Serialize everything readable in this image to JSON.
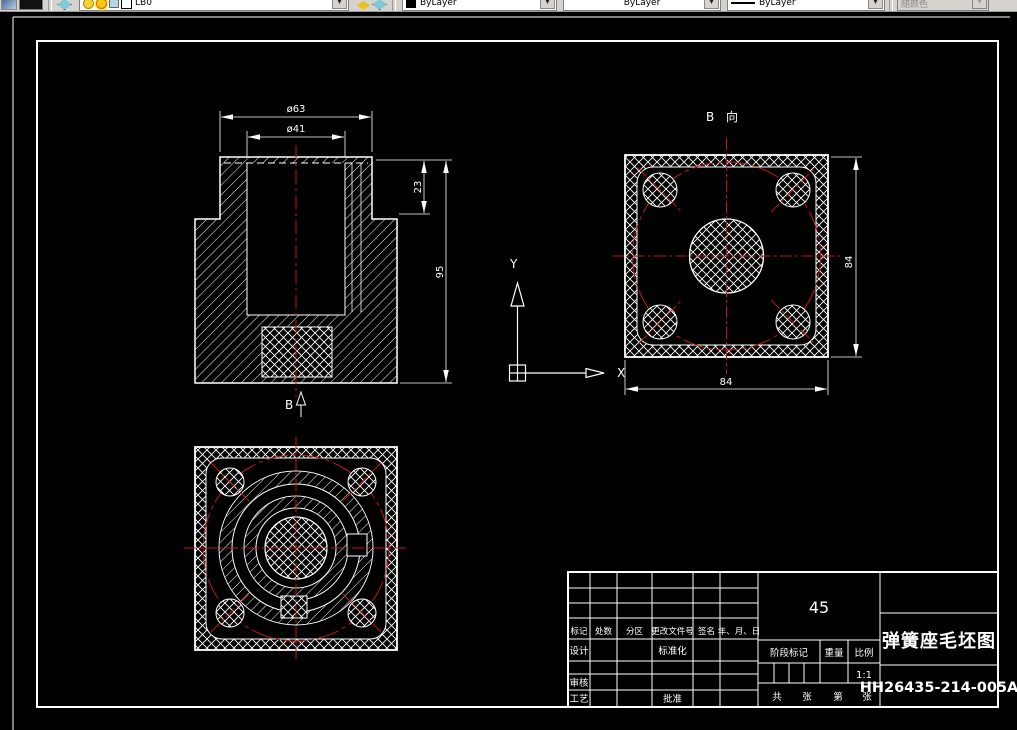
{
  "colors": {
    "background": "#000000",
    "line": "#ffffff",
    "centerline_red": "#c01818",
    "toolbar_gray": "#d6d3ce"
  },
  "toolbar": {
    "layer_value": "LB0",
    "color_value": "ByLayer",
    "linetype_value": "ByLayer",
    "lineweight_value": "ByLayer",
    "plotstyle_value": "随颜色"
  },
  "views": {
    "section": {
      "dim_outer_diameter": "ø63",
      "dim_inner_diameter": "ø41",
      "dim_boss_height": "23",
      "dim_total_height": "95",
      "direction_label": "B"
    },
    "b_view": {
      "label": "B 向",
      "dim_width": "84",
      "dim_height": "84"
    },
    "ucs": {
      "x_label": "X",
      "y_label": "Y"
    }
  },
  "title_block": {
    "material": "45",
    "title": "弹簧座毛坯图",
    "drawing_number": "HH26435-214-005A",
    "col_headers": [
      "标记",
      "处数",
      "分区",
      "更改文件号",
      "签名",
      "年、月、日"
    ],
    "row_labels": {
      "design": "设计",
      "standardization": "标准化",
      "review": "审核",
      "process": "工艺",
      "approve": "批准"
    },
    "stage_header": "阶段标记",
    "weight_header": "重量",
    "scale_header": "比例",
    "scale_value": "1:1",
    "sheet_labels": [
      "共",
      "张",
      "第",
      "张"
    ]
  }
}
